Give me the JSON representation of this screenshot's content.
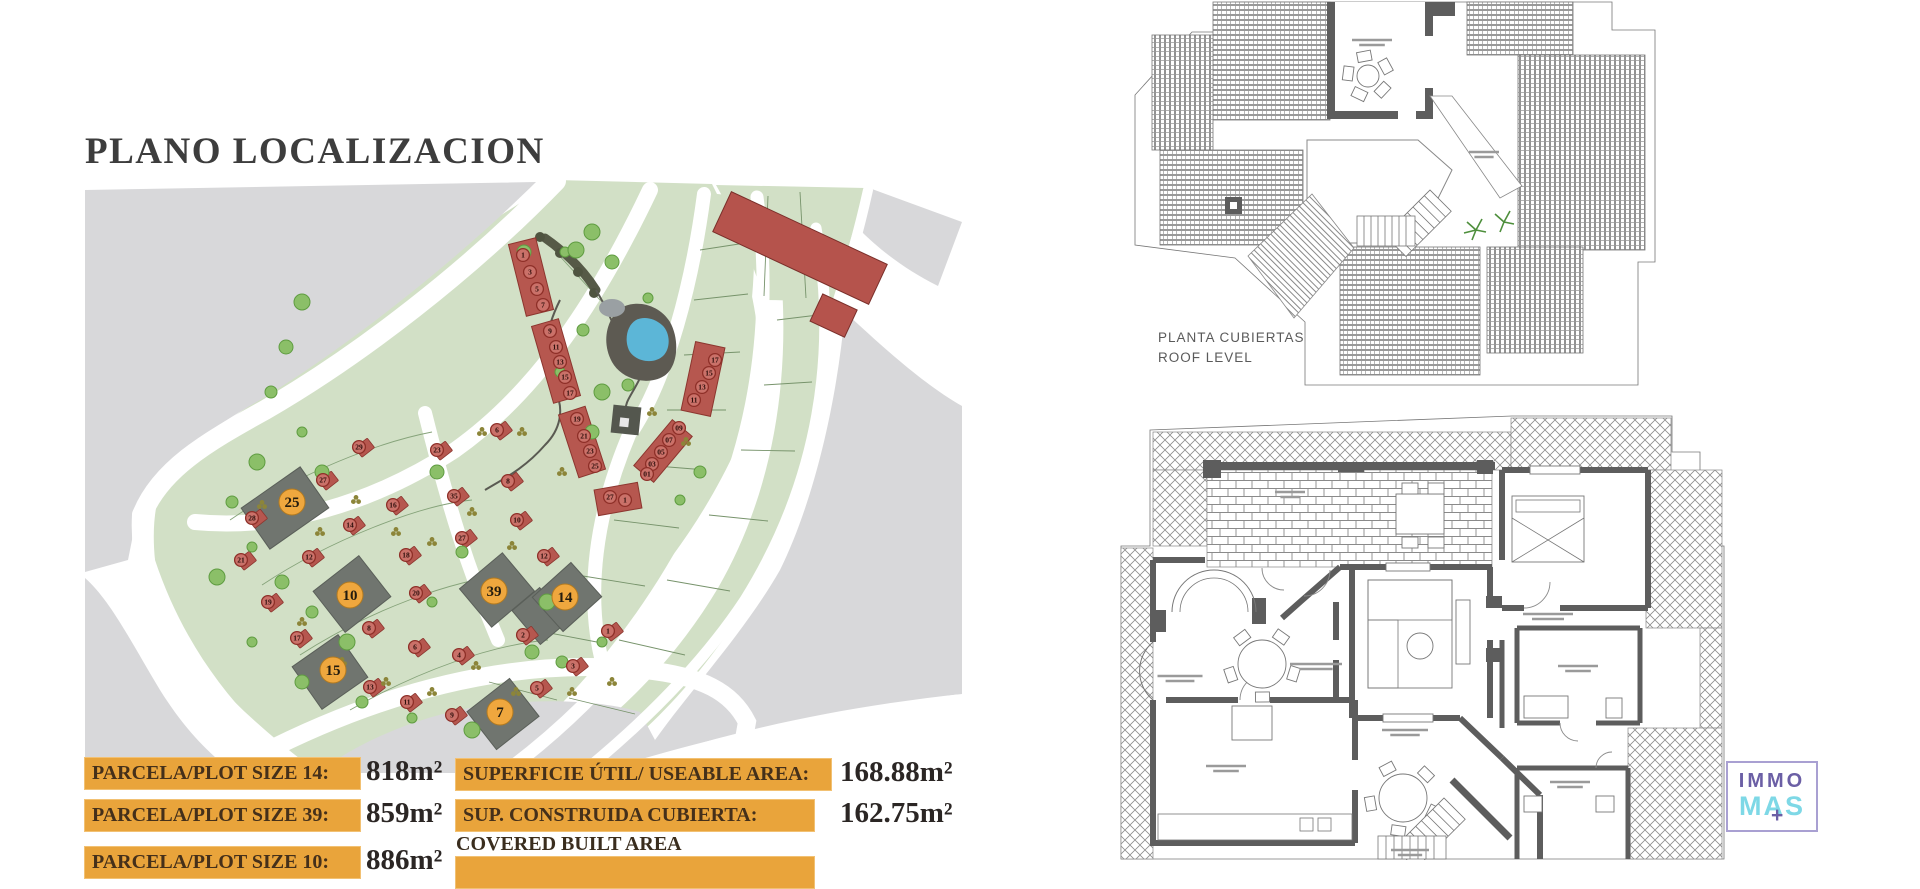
{
  "page": {
    "title": "PLANO LOCALIZACION"
  },
  "site_plan": {
    "highlighted_plots": [
      {
        "n": "25",
        "x": 292,
        "y": 502
      },
      {
        "n": "10",
        "x": 350,
        "y": 595
      },
      {
        "n": "39",
        "x": 494,
        "y": 591
      },
      {
        "n": "14",
        "x": 565,
        "y": 597
      },
      {
        "n": "15",
        "x": 333,
        "y": 670
      },
      {
        "n": "7",
        "x": 500,
        "y": 712
      }
    ],
    "strip_units": [
      {
        "n": "1",
        "x": 523,
        "y": 255
      },
      {
        "n": "3",
        "x": 530,
        "y": 272
      },
      {
        "n": "5",
        "x": 537,
        "y": 289
      },
      {
        "n": "7",
        "x": 543,
        "y": 305
      },
      {
        "n": "9",
        "x": 550,
        "y": 331
      },
      {
        "n": "11",
        "x": 556,
        "y": 347
      },
      {
        "n": "13",
        "x": 560,
        "y": 362
      },
      {
        "n": "15",
        "x": 565,
        "y": 377
      },
      {
        "n": "17",
        "x": 570,
        "y": 393
      },
      {
        "n": "19",
        "x": 577,
        "y": 419
      },
      {
        "n": "21",
        "x": 584,
        "y": 436
      },
      {
        "n": "23",
        "x": 590,
        "y": 451
      },
      {
        "n": "25",
        "x": 595,
        "y": 466
      },
      {
        "n": "17",
        "x": 715,
        "y": 360
      },
      {
        "n": "15",
        "x": 709,
        "y": 373
      },
      {
        "n": "13",
        "x": 702,
        "y": 387
      },
      {
        "n": "11",
        "x": 694,
        "y": 400
      },
      {
        "n": "09",
        "x": 679,
        "y": 428
      },
      {
        "n": "07",
        "x": 669,
        "y": 440
      },
      {
        "n": "05",
        "x": 661,
        "y": 452
      },
      {
        "n": "03",
        "x": 652,
        "y": 464
      },
      {
        "n": "01",
        "x": 647,
        "y": 474
      },
      {
        "n": "27",
        "x": 610,
        "y": 497
      },
      {
        "n": "1",
        "x": 625,
        "y": 500
      }
    ],
    "houses": [
      {
        "n": "28",
        "x": 252,
        "y": 518
      },
      {
        "n": "27",
        "x": 323,
        "y": 480
      },
      {
        "n": "29",
        "x": 359,
        "y": 447
      },
      {
        "n": "21",
        "x": 241,
        "y": 560
      },
      {
        "n": "19",
        "x": 268,
        "y": 602
      },
      {
        "n": "17",
        "x": 297,
        "y": 638
      },
      {
        "n": "13",
        "x": 370,
        "y": 687
      },
      {
        "n": "11",
        "x": 407,
        "y": 702
      },
      {
        "n": "9",
        "x": 452,
        "y": 715
      },
      {
        "n": "14",
        "x": 350,
        "y": 525
      },
      {
        "n": "12",
        "x": 309,
        "y": 557
      },
      {
        "n": "16",
        "x": 393,
        "y": 505
      },
      {
        "n": "18",
        "x": 406,
        "y": 555
      },
      {
        "n": "20",
        "x": 416,
        "y": 593
      },
      {
        "n": "8",
        "x": 369,
        "y": 628
      },
      {
        "n": "6",
        "x": 415,
        "y": 647
      },
      {
        "n": "4",
        "x": 459,
        "y": 655
      },
      {
        "n": "6",
        "x": 497,
        "y": 430
      },
      {
        "n": "23",
        "x": 437,
        "y": 450
      },
      {
        "n": "8",
        "x": 508,
        "y": 481
      },
      {
        "n": "35",
        "x": 454,
        "y": 496
      },
      {
        "n": "27",
        "x": 462,
        "y": 538
      },
      {
        "n": "10",
        "x": 517,
        "y": 520
      },
      {
        "n": "12",
        "x": 544,
        "y": 556
      },
      {
        "n": "2",
        "x": 523,
        "y": 635
      },
      {
        "n": "1",
        "x": 608,
        "y": 631
      },
      {
        "n": "3",
        "x": 573,
        "y": 666
      },
      {
        "n": "5",
        "x": 537,
        "y": 688
      }
    ],
    "colors": {
      "terrain": "#d2e0c6",
      "other_land": "#d8d8da",
      "road": "#ffffff",
      "house": "#b6574f",
      "highlight_marker": "#efa73e",
      "plot": "#70756f",
      "pond": "#5cb6d7",
      "tree": "#8bbf68"
    }
  },
  "roof_plan": {
    "label_line1": "PLANTA CUBIERTAS",
    "label_line2": "ROOF LEVEL"
  },
  "areas_table": {
    "plots": [
      {
        "label": "PARCELA/PLOT SIZE 14:",
        "value": "818m²"
      },
      {
        "label": "PARCELA/PLOT SIZE 39:",
        "value": "859m²"
      },
      {
        "label": "PARCELA/PLOT SIZE 10:",
        "value": "886m²"
      }
    ],
    "areas": [
      {
        "label": "SUPERFICIE ÚTIL/ USEABLE AREA:",
        "value": "168.88m²",
        "sublabel": ""
      },
      {
        "label": "SUP. CONSTRUIDA CUBIERTA:",
        "value": "162.75m²",
        "sublabel": "COVERED BUILT AREA"
      }
    ]
  },
  "logo": {
    "top": "IMMO",
    "bottom": "MAS",
    "plus": "+"
  }
}
